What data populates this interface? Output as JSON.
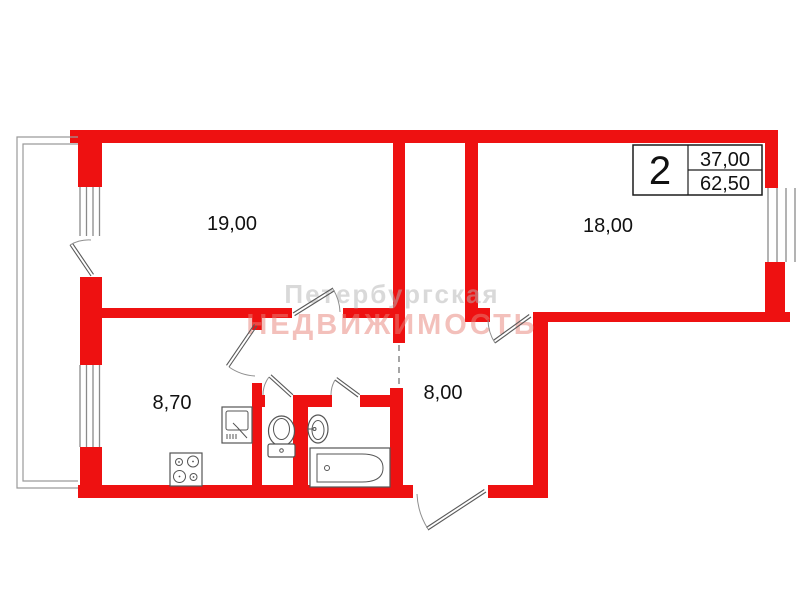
{
  "plan": {
    "rooms": {
      "living": {
        "area": "19,00"
      },
      "bedroom": {
        "area": "18,00"
      },
      "kitchen": {
        "area": "8,70"
      },
      "hallway": {
        "area": "8,00"
      }
    },
    "info_box": {
      "room_count": "2",
      "living_area": "37,00",
      "total_area": "62,50"
    },
    "watermark": {
      "line1": "Петербургская",
      "line2": "НЕДВИЖИМОСТЬ"
    }
  },
  "colors": {
    "wall": "#ee1111",
    "fixture_outline": "#555555",
    "label_text": "#111111"
  }
}
